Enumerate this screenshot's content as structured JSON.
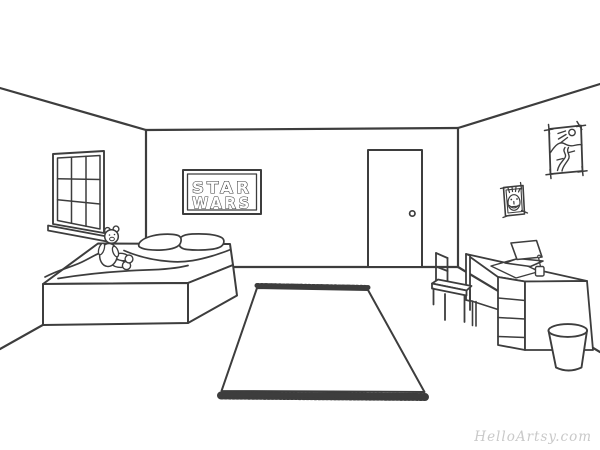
{
  "image": {
    "kind": "line-art coloring page",
    "subject": "bedroom interior drawn in one-point perspective",
    "background_color": "#ffffff",
    "line_color": "#3d3d3d"
  },
  "poster": {
    "line1": "STAR",
    "line2": "WARS"
  },
  "watermark": {
    "text": "HelloArtsy.com",
    "color": "#c9c9c9"
  },
  "objects": [
    "window",
    "window-sill",
    "bed",
    "pillows",
    "blanket",
    "teddy-bear",
    "star-wars-poster",
    "door",
    "door-knob",
    "landscape-picture",
    "portrait-picture",
    "desk",
    "desk-drawers",
    "laptop",
    "pencil-cup",
    "desk-chair",
    "waste-basket",
    "area-rug"
  ]
}
